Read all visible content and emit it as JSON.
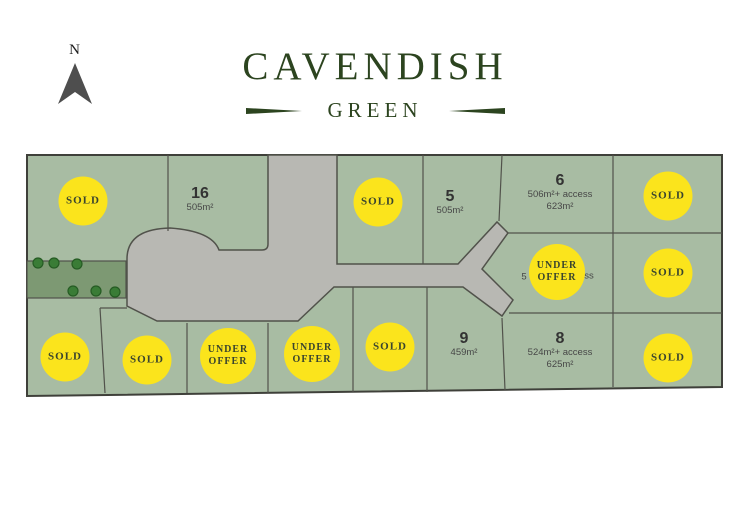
{
  "compass": {
    "label": "N"
  },
  "title": {
    "main": "CAVENDISH",
    "sub": "GREEN"
  },
  "colors": {
    "title_green": "#2c441f",
    "plan_green": "#a8bca3",
    "road_gray": "#b8b8b3",
    "reserve_green": "#7d9973",
    "tree_green": "#3a7c36",
    "tree_edge": "#265c24",
    "line_dark": "#51524b",
    "border_dark": "#3f403a",
    "badge_yellow": "#fbe41c",
    "badge_text": "#39442e"
  },
  "lots": {
    "lot16": {
      "number": "16",
      "area": "505m²"
    },
    "lot5": {
      "number": "5",
      "area": "505m²"
    },
    "lot6": {
      "number": "6",
      "area_line1": "506m²+ access",
      "area_line2": "623m²"
    },
    "lot7": {
      "fragment_left": "5",
      "fragment_right": "ss"
    },
    "lot9": {
      "number": "9",
      "area": "459m²"
    },
    "lot8": {
      "number": "8",
      "area_line1": "524m²+ access",
      "area_line2": "625m²"
    }
  },
  "badges": [
    {
      "label": "SOLD"
    },
    {
      "label": "SOLD"
    },
    {
      "label": "SOLD"
    },
    {
      "label": "UNDER OFFER"
    },
    {
      "label": "SOLD"
    },
    {
      "label": "SOLD"
    },
    {
      "label": "SOLD"
    },
    {
      "label": "UNDER OFFER"
    },
    {
      "label": "UNDER OFFER"
    },
    {
      "label": "SOLD"
    },
    {
      "label": "SOLD"
    }
  ]
}
